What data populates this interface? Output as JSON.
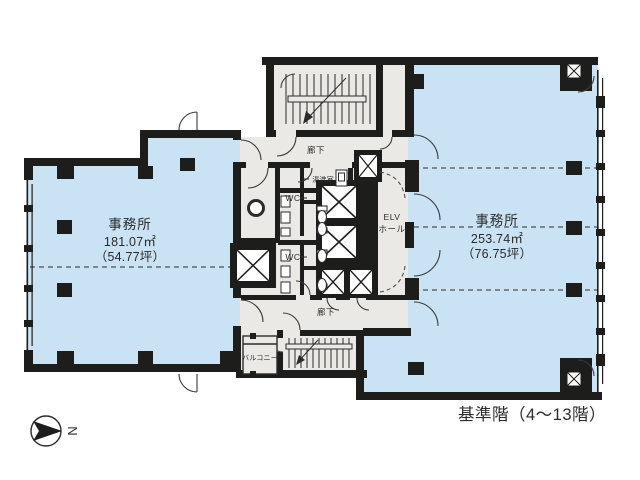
{
  "caption": "基準階（4〜13階）",
  "compass": {
    "letter": "N"
  },
  "office_left": {
    "name": "事務所",
    "area_m2": "181.07㎡",
    "area_tsubo": "（54.77坪）"
  },
  "office_right": {
    "name": "事務所",
    "area_m2": "253.74㎡",
    "area_tsubo": "（76.75坪）"
  },
  "corridor_top": {
    "name": "廊下"
  },
  "corridor_bottom": {
    "name": "廊下"
  },
  "kitchenette": {
    "name": "湯沸室"
  },
  "wc_upper": {
    "name": "WC"
  },
  "wc_lower": {
    "name": "WC"
  },
  "elevator_hall": {
    "line1": "ELV",
    "line2": "ホール"
  },
  "balcony": {
    "name": "バルコニー"
  },
  "colors": {
    "room_fill": "#c9e2f4",
    "core_fill": "#eae9e6",
    "wall": "#1d1d1b",
    "dash": "#4f4f4f",
    "text": "#2b2b2b"
  }
}
